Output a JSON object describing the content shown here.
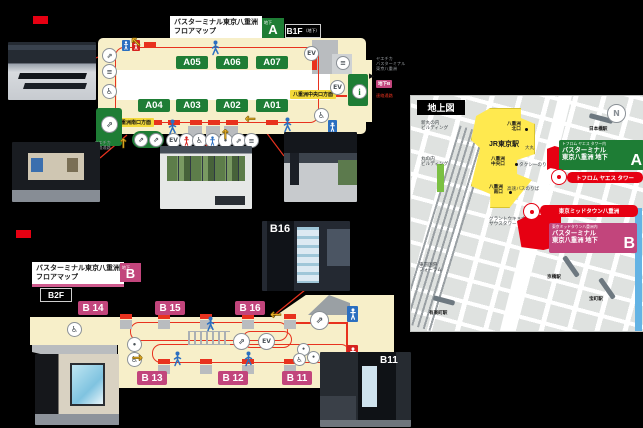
{
  "colors": {
    "accent_red": "#e60012",
    "route_red": "#e8321e",
    "map_cream": "#f7efc9",
    "stop_green": "#1e7d35",
    "brand_pink": "#c2457c",
    "direction_label_yellow": "#f3d93a",
    "arrow_gold": "#f2b52a",
    "station_yellow": "#ffe94f"
  },
  "icons": {
    "elevator": "EV",
    "info": "i",
    "stairs": "≡",
    "escalator": "⇗",
    "wheelchair": "♿",
    "north": "N",
    "dot": "•",
    "exit_arrow": "▶",
    "arrow_up": "↑",
    "arrow_left": "←",
    "arrow_up_left": "↖",
    "arrow_right": "→"
  },
  "b1f": {
    "title_line1": "バスターミナル東京八重洲",
    "title_line2": "フロアマップ",
    "area_badge_small": "地下",
    "area_badge_letter": "A",
    "floor_badge": "B1F",
    "floor_badge_sub": "（地下）",
    "stops": [
      "A05",
      "A06",
      "A07",
      "A04",
      "A03",
      "A02",
      "A01"
    ],
    "label_south_exit": "八重洲南口方面",
    "label_central_exit": "八重洲中央口方面",
    "underpass_note_line1": "ヤエチカ",
    "underpass_note_line2": "連絡通路",
    "side_note_line1": "ヤエチカ",
    "side_note_line2": "バスターミナル",
    "side_note_line3": "東京八重洲",
    "side_note_badge": "地下B",
    "side_note_red": "連絡通路"
  },
  "b2f": {
    "title_line1": "バスターミナル東京八重洲",
    "title_line2": "フロアマップ",
    "area_badge_small": "地下",
    "area_badge_letter": "B",
    "floor_badge": "B2F",
    "stops": [
      "B 14",
      "B 15",
      "B 16",
      "B 13",
      "B 12",
      "B 11"
    ]
  },
  "photos": {
    "b16_pillar_label": "B16",
    "b11_pillar_label": "B11"
  },
  "ground_map": {
    "title": "地上図",
    "station": "JR東京駅",
    "exit_north_l1": "八重洲",
    "exit_north_l2": "北口",
    "exit_central_l1": "八重洲",
    "exit_central_l2": "中央口",
    "exit_south_l1": "八重洲",
    "exit_south_l2": "南口",
    "daimaru": "大丸",
    "nihombashi_sta": "日本橋駅",
    "shin_marunouchi_l1": "新丸の内",
    "shin_marunouchi_l2": "ビルディング",
    "marunouchi_l1": "丸の内",
    "marunouchi_l2": "ビルディング",
    "taxi_stand": "タクシーのりば",
    "highway_bus_stand": "高速バスのりば",
    "gran_tokyo_l1": "グラントウキョウ",
    "gran_tokyo_l2": "サウスタワー",
    "intl_forum_l1": "東京国際",
    "intl_forum_l2": "フォーラム",
    "yurakucho_sta": "有楽町駅",
    "kyobashi_sta": "京橋駅",
    "takaracho_sta": "宝町駅",
    "callout_a_sub": "トフロム ヤエス タワー内",
    "callout_a_l1": "バスターミナル",
    "callout_a_l2": "東京八重洲 地下",
    "callout_a_letter": "A",
    "pin_tower_label": "トフロム ヤエス タワー",
    "pin_midtown_label": "東京ミッドタウン八重洲",
    "callout_b_sub": "東京ミッドタウン八重洲内",
    "callout_b_l1": "バスターミナル",
    "callout_b_l2": "東京八重洲 地下",
    "callout_b_letter": "B"
  }
}
